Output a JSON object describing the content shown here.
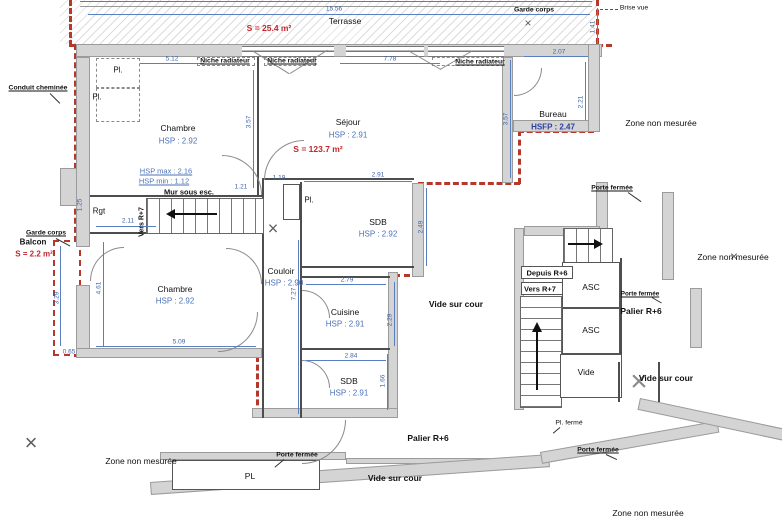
{
  "drawing": {
    "type": "architectural floor plan, level R+6",
    "measured_area_label": "S = 123.7 m²"
  },
  "rooms": {
    "terrasse": {
      "name": "Terrasse",
      "area": "S = 25.4 m²"
    },
    "chambre1": {
      "name": "Chambre",
      "hsp": "HSP : 2.92"
    },
    "sejour": {
      "name": "Séjour",
      "hsp": "HSP : 2.91"
    },
    "bureau": {
      "name": "Bureau",
      "hsp": "HSFP : 2.47"
    },
    "sdb1": {
      "name": "SDB",
      "hsp": "HSP : 2.92"
    },
    "chambre2": {
      "name": "Chambre",
      "hsp": "HSP : 2.92"
    },
    "couloir": {
      "name": "Couloir",
      "hsp": "HSP : 2.90"
    },
    "cuisine": {
      "name": "Cuisine",
      "hsp": "HSP : 2.91"
    },
    "sdb2": {
      "name": "SDB",
      "hsp": "HSP : 2.91"
    },
    "balcon": {
      "name": "Balcon",
      "area": "S = 2.2 m²"
    },
    "rgt": "Rgt",
    "vide": "Vide",
    "asc": "ASC",
    "palier_r6": "Palier R+6",
    "vide_sur_cour": "Vide sur cour",
    "zone_non_mesuree": "Zone non mesurée",
    "pl_abbr": "Pl.",
    "pl_upper": "PL"
  },
  "annotations": {
    "garde_corps": "Garde corps",
    "brise_vue": "Brise vue",
    "conduit_cheminee": "Conduit cheminée",
    "niche_radiateur": "Niche radiateur",
    "mur_sous_esc": "Mur sous esc.",
    "hsp_max": "HSP max : 2.16",
    "hsp_min": "HSP min : 1.12",
    "vers_r7": "Vers R+7",
    "depuis_r6": "Depuis R+6",
    "porte_fermee": "Porte fermée",
    "pl_ferme": "Pl. fermé"
  },
  "dimensions": {
    "terrasse_length": "15.56",
    "terrasse_depth": "1.41",
    "bureau_width": "2.07",
    "bureau_depth": "2.21",
    "chambre1_width": "5.12",
    "chambre1_depth": "3.57",
    "sejour_width": "7.78",
    "sejour_depth": "3.57",
    "passage1": "1.21",
    "passage2": "1.19",
    "sdb1_width": "2.91",
    "sdb1_depth": "2.49",
    "rgt_width": "2.11",
    "rgt_depth": "1.25",
    "couloir_length": "7.27",
    "cuisine_width": "2.79",
    "cuisine_depth": "2.29",
    "sdb2_width": "2.84",
    "sdb2_depth": "1.66",
    "chambre2_width": "5.09",
    "chambre2_depth": "4.61",
    "balcon_length": "3.29",
    "balcon_width": "0.65"
  },
  "colors": {
    "boundary_red": "#b5382a",
    "dimension_blue": "#3c63a8",
    "hsp_blue": "#4a72b8",
    "wall_gray": "#d4d4d4"
  }
}
